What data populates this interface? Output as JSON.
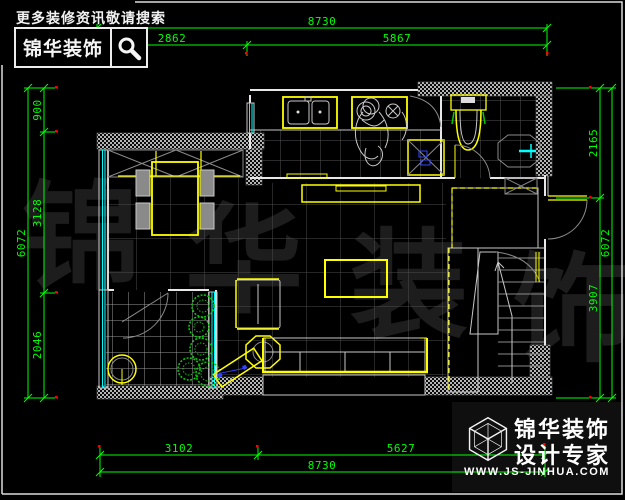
{
  "header_brand": {
    "tagline": "更多装修资讯敬请搜索",
    "brand_name": "锦华装饰"
  },
  "footer_brand": {
    "line1": "锦华装饰",
    "line2": "设计专家",
    "url": "WWW.JS-JINHUA.COM"
  },
  "watermark": {
    "chars": [
      "锦",
      "华",
      "装",
      "饰"
    ]
  },
  "dimensions": {
    "top_total": "8730",
    "top_seg1": "2862",
    "top_seg2": "5867",
    "bottom_seg1": "3102",
    "bottom_seg2": "5627",
    "bottom_total": "8730",
    "left_seg1": "900",
    "left_seg2": "3128",
    "left_seg3": "2046",
    "left_total": "6072",
    "right_seg1": "2165",
    "right_seg2": "3907",
    "right_total": "6072"
  },
  "colors": {
    "dimension_line": "#00ff00",
    "furniture": "#ffff00",
    "glass_window": "#00ffff",
    "wall": "#e8e8e8",
    "plant": "#00cc00",
    "fixture_blue": "#3344ff",
    "tick_dot": "#ff0000",
    "background": "#000000"
  }
}
